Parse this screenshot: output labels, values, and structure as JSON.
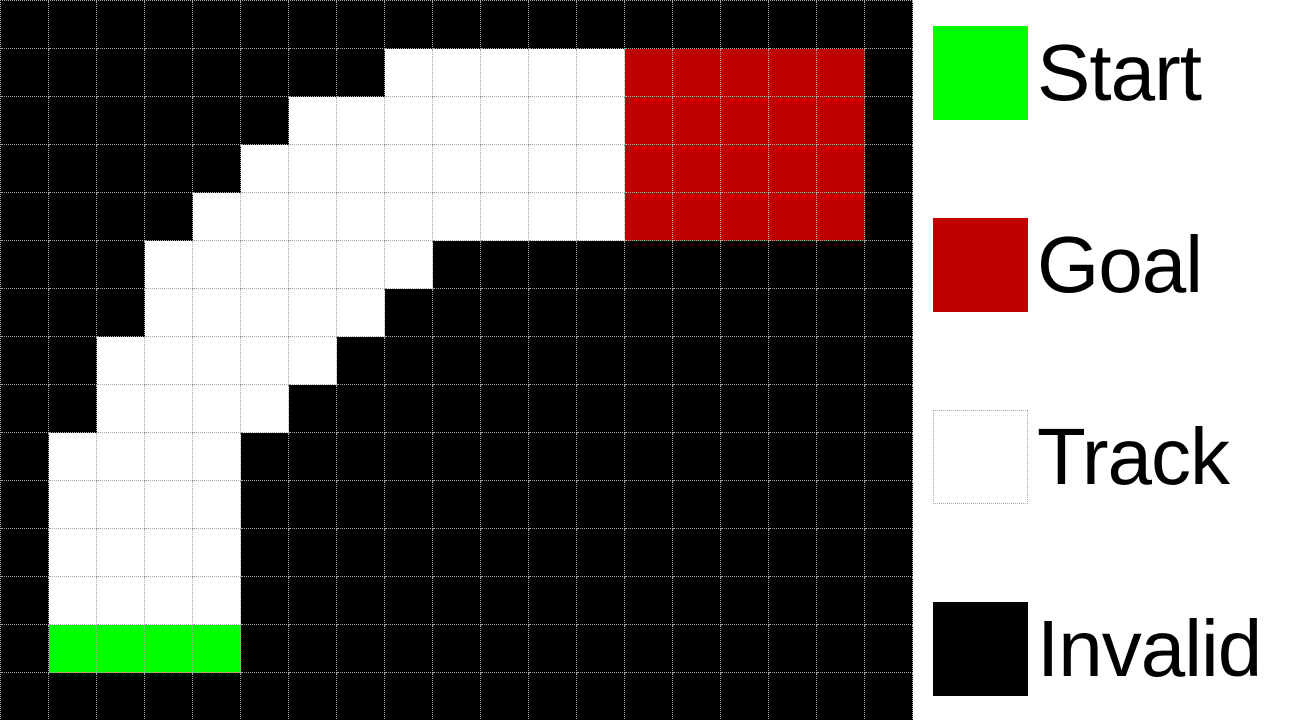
{
  "figure": {
    "type": "racetrack-grid-visualization"
  },
  "colors": {
    "start": "#00FF00",
    "goal": "#C00000",
    "track": "#FFFFFF",
    "invalid": "#000000",
    "grid_line": "#A9A9A9",
    "legend_text": "#000000",
    "background": "#FFFFFF"
  },
  "board": {
    "columns": 19,
    "rows": 15,
    "cell_size_px": 48,
    "legend_codes": {
      ".": "invalid",
      "T": "track",
      "S": "start",
      "G": "goal"
    },
    "rows_map": [
      "...................",
      "........TTTTTGGGGG.",
      "......TTTTTTTGGGGG.",
      ".....TTTTTTTTGGGGG.",
      "....TTTTTTTTTGGGGG.",
      "...TTTTTT..........",
      "...TTTTT...........",
      "..TTTTT............",
      "..TTTT.............",
      ".TTTT..............",
      ".TTTT..............",
      ".TTTT..............",
      ".TTTT..............",
      ".SSSS..............",
      "..................."
    ]
  },
  "legend": {
    "items": [
      {
        "label": "Start",
        "type": "start",
        "color": "#00FF00",
        "swatch_border": "none"
      },
      {
        "label": "Goal",
        "type": "goal",
        "color": "#C00000",
        "swatch_border": "none"
      },
      {
        "label": "Track",
        "type": "track",
        "color": "#FFFFFF",
        "swatch_border": "dotted"
      },
      {
        "label": "Invalid",
        "type": "invalid",
        "color": "#000000",
        "swatch_border": "none"
      }
    ]
  }
}
